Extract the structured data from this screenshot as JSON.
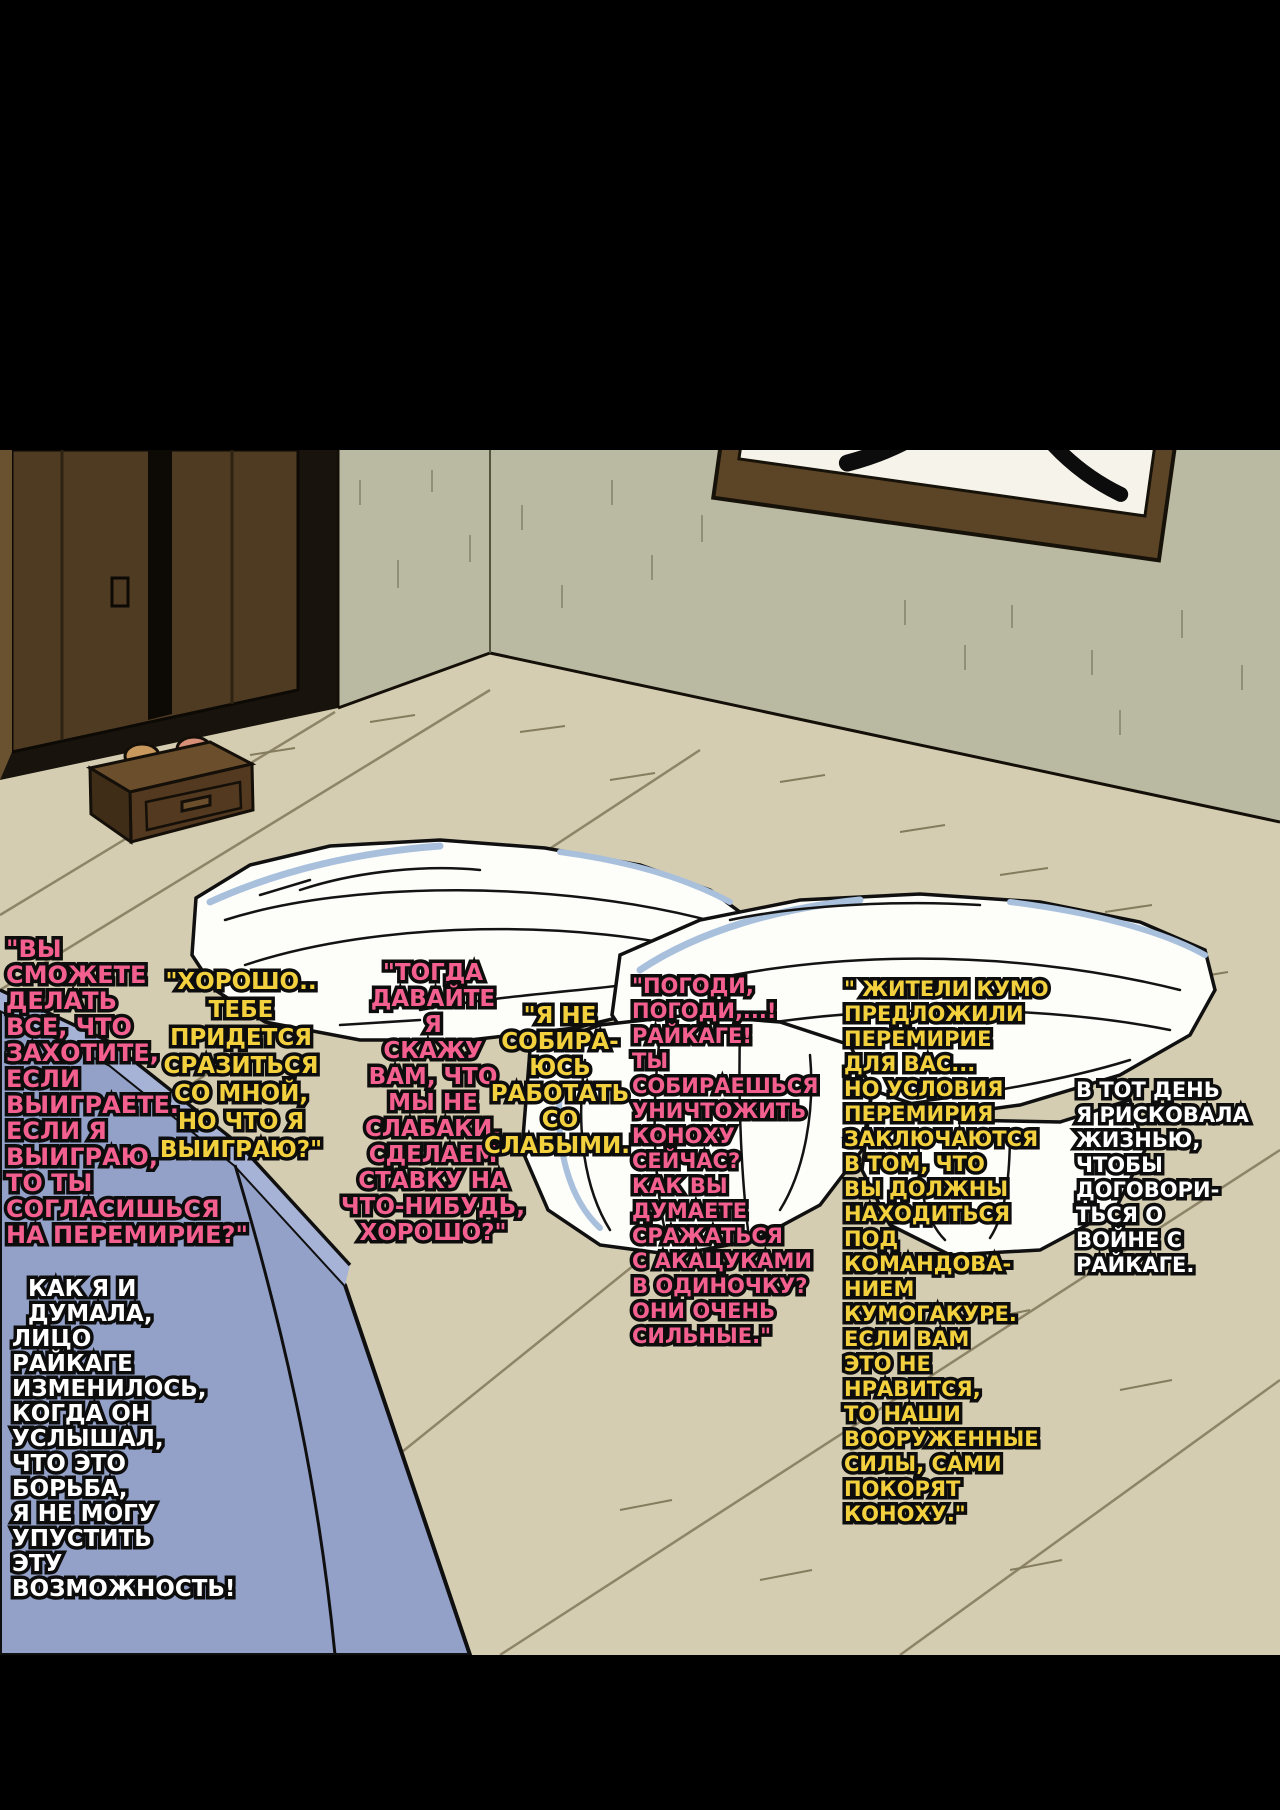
{
  "page": {
    "type": "manga-page",
    "language": "Russian",
    "frame_color": "#000000"
  },
  "scene": {
    "objects": {
      "door": "dark wooden sliding door",
      "wall_scroll": "framed calligraphy scroll",
      "nightstand": "wooden drawer chest with two small items",
      "futon": "white crumpled futon bedding",
      "couch": "blue couch corner"
    },
    "colors": {
      "wall": "#b9baa1",
      "floor": "#d5cdb1",
      "door_wood": "#4e3b22",
      "scroll_frame": "#5c4526",
      "scroll_paper": "#f6f4ea",
      "drawer_wood": "#52391f",
      "futon_white": "#fdfdfa",
      "futon_shade_blue": "#a9c0dc",
      "couch_blue": "#93a1c9",
      "outline": "#0d0d0d",
      "speech_pink": "#f3608f",
      "speech_yellow": "#f3d13e",
      "narration_white": "#ffffff"
    }
  },
  "texts": {
    "b1": {
      "color": "#f3608f",
      "text": "\"ВЫ\nСМОЖЕТЕ\nДЕЛАТЬ\nВСЕ, ЧТО\nЗАХОТИТЕ,\nЕСЛИ\nВЫИГРАЕТЕ.\nЕСЛИ Я\nВЫИГРАЮ,\nТО ТЫ\nСОГЛАСИШЬСЯ\nНА ПЕРЕМИРИЕ?\""
    },
    "b2": {
      "color": "#f3d13e",
      "text": "\"ХОРОШО..\nТЕБЕ\nПРИДЕТСЯ\nСРАЗИТЬСЯ\nСО МНОЙ,\nНО ЧТО Я\nВЫИГРАЮ?\""
    },
    "b3": {
      "color": "#f3608f",
      "text": "\"ТОГДА\nДАВАЙТЕ\nЯ\nСКАЖУ\nВАМ, ЧТО\nМЫ НЕ\nСЛАБАКИ,\nСДЕЛАЕМ\nСТАВКУ НА\nЧТО-НИБУДЬ,\nХОРОШО?\""
    },
    "b4": {
      "color": "#f3d13e",
      "text": "\"Я НЕ\nСОБИРА-\nЮСЬ\nРАБОТАТЬ\nСО\nСЛАБЫМИ.\""
    },
    "b5": {
      "color": "#f3608f",
      "text": "\"ПОГОДИ,\nПОГОДИ,...!\nРАЙКАГЕ!\nТЫ\nСОБИРАЕШЬСЯ\nУНИЧТОЖИТЬ\nКОНОХУ\nСЕЙЧАС?\nКАК ВЫ\nДУМАЕТЕ\nСРАЖАТЬСЯ\nС АКАЦУКАМИ\nВ ОДИНОЧКУ?\nОНИ ОЧЕНЬ\nСИЛЬНЫЕ.\""
    },
    "b6": {
      "color": "#f3d13e",
      "text": "\" ЖИТЕЛИ КУМО\nПРЕДЛОЖИЛИ\nПЕРЕМИРИЕ\nДЛЯ ВАС...\nНО УСЛОВИЯ\nПЕРЕМИРИЯ\nЗАКЛЮЧАЮТСЯ\nВ ТОМ, ЧТО\nВЫ ДОЛЖНЫ\nНАХОДИТЬСЯ\nПОД\nКОМАНДОВА-\nНИЕМ\nКУМОГАКУРЕ.\nЕСЛИ ВАМ\nЭТО НЕ\nНРАВИТСЯ,\nТО НАШИ\nВООРУЖЕННЫЕ\nСИЛЫ, САМИ\nПОКОРЯТ\nКОНОХУ.\""
    },
    "b7": {
      "color": "#ffffff",
      "text": "В ТОТ ДЕНЬ\nЯ РИСКОВАЛА\nЖИЗНЬЮ,\nЧТОБЫ\nДОГОВОРИ-\nТЬСЯ О\nВОЙНЕ С\nРАЙКАГЕ."
    },
    "b8": {
      "color": "#ffffff",
      "text": "  КАК Я И\n  ДУМАЛА,\nЛИЦО\nРАЙКАГЕ\nИЗМЕНИЛОСЬ,\nКОГДА ОН\nУСЛЫШАЛ,\nЧТО ЭТО\nБОРЬБА,\nЯ НЕ МОГУ\nУПУСТИТЬ\nЭТУ\nВОЗМОЖНОСТЬ!"
    }
  }
}
